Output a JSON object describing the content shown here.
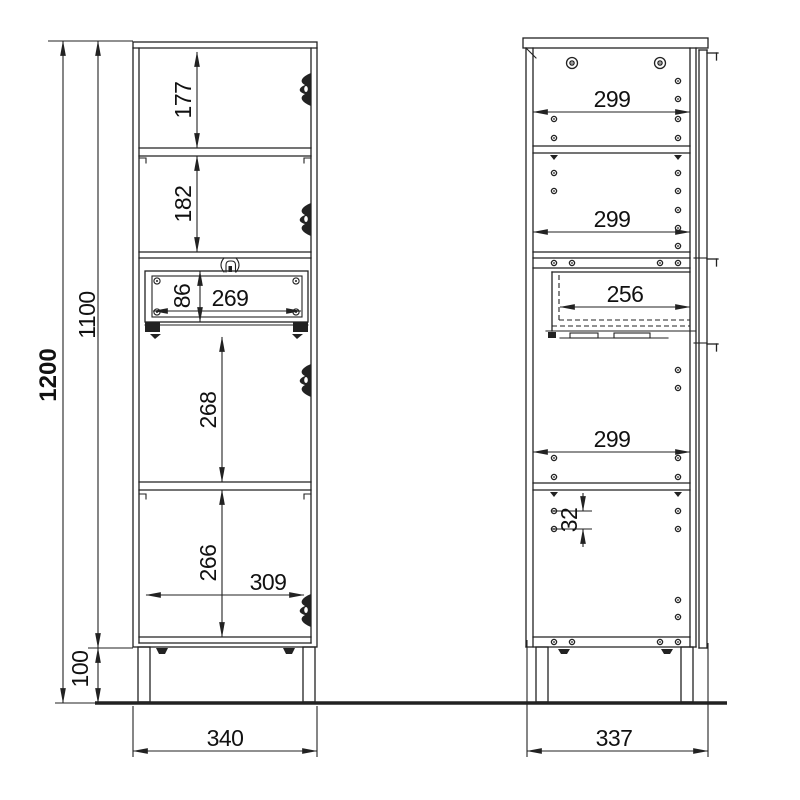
{
  "front_view": {
    "overall_height": "1200",
    "carcass_height": "1100",
    "leg_height": "100",
    "overall_width": "340",
    "compartment_1_height": "177",
    "compartment_2_height": "182",
    "drawer_front_height": "86",
    "drawer_front_width": "269",
    "compartment_3_height": "268",
    "compartment_4_height": "266",
    "interior_width": "309"
  },
  "side_view": {
    "overall_width": "337",
    "shelf_depth_top": "299",
    "shelf_depth_middle": "299",
    "drawer_depth": "256",
    "shelf_depth_bottom": "299",
    "hole_spacing": "32"
  },
  "colors": {
    "line": "#222222",
    "background": "#ffffff"
  }
}
